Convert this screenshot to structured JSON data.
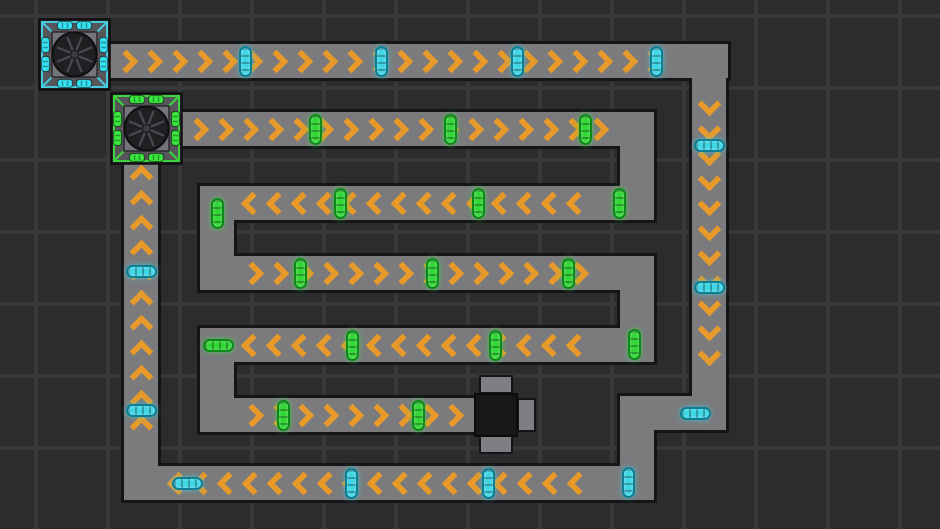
{
  "scene": {
    "width": 940,
    "height": 529,
    "description": "top-down conveyor-belt factory puzzle"
  },
  "palette": {
    "background": "#2c2c2e",
    "grid_line": "#38383a",
    "belt_fill": "#7b7b7d",
    "belt_border": "#151517",
    "chevron_orange": "#e79929",
    "cyan_item_fill": "#3fd6e6",
    "cyan_item_border": "#0d7f95",
    "green_item_fill": "#32d636",
    "green_item_border": "#0c8a18",
    "machine_body": "#55555a",
    "machine_face": "#74747a",
    "machine_circle": "#202023",
    "machine_spoke": "#494950",
    "cyan_accent": "#45cadc",
    "cyan_port": "#35e2f2",
    "green_accent": "#3bd43f",
    "green_port": "#3ae83e",
    "consumer_tab": "#7e7e82",
    "consumer_core": "#18181a"
  },
  "grid": {
    "spacing": 72,
    "line_width": 4
  },
  "chevron": {
    "spacing": 25,
    "arm": 17,
    "thickness": 6
  },
  "belts": [
    {
      "name": "top-run",
      "x": 108,
      "y": 44,
      "w": 620,
      "h": 34,
      "dir": "right",
      "chev": true,
      "m1": 10,
      "m2": 44
    },
    {
      "name": "right-run",
      "x": 692,
      "y": 44,
      "w": 34,
      "h": 386,
      "dir": "down",
      "chev": true,
      "m1": 52,
      "m2": 46
    },
    {
      "name": "jog-horizontal",
      "x": 620,
      "y": 396,
      "w": 106,
      "h": 34,
      "dir": "left",
      "chev": false,
      "m1": 0,
      "m2": 0
    },
    {
      "name": "jog-vertical",
      "x": 620,
      "y": 396,
      "w": 34,
      "h": 104,
      "dir": "down",
      "chev": false,
      "m1": 0,
      "m2": 0
    },
    {
      "name": "bottom-run",
      "x": 124,
      "y": 466,
      "w": 530,
      "h": 34,
      "dir": "left",
      "chev": true,
      "m1": 46,
      "m2": 44
    },
    {
      "name": "left-run",
      "x": 124,
      "y": 160,
      "w": 34,
      "h": 340,
      "dir": "up",
      "chev": true,
      "m1": 8,
      "m2": 44
    },
    {
      "name": "row-a",
      "x": 181,
      "y": 112,
      "w": 473,
      "h": 34,
      "dir": "right",
      "chev": true,
      "m1": 8,
      "m2": 44
    },
    {
      "name": "turn-a-b",
      "x": 620,
      "y": 112,
      "w": 34,
      "h": 108,
      "dir": "down",
      "chev": false,
      "m1": 0,
      "m2": 0
    },
    {
      "name": "row-b",
      "x": 200,
      "y": 186,
      "w": 454,
      "h": 34,
      "dir": "left",
      "chev": true,
      "m1": 44,
      "m2": 44
    },
    {
      "name": "turn-b-c",
      "x": 200,
      "y": 186,
      "w": 34,
      "h": 104,
      "dir": "down",
      "chev": false,
      "m1": 0,
      "m2": 0
    },
    {
      "name": "row-c",
      "x": 200,
      "y": 256,
      "w": 454,
      "h": 34,
      "dir": "right",
      "chev": true,
      "m1": 44,
      "m2": 44
    },
    {
      "name": "turn-c-d",
      "x": 620,
      "y": 256,
      "w": 34,
      "h": 106,
      "dir": "down",
      "chev": false,
      "m1": 0,
      "m2": 0
    },
    {
      "name": "row-d",
      "x": 200,
      "y": 328,
      "w": 454,
      "h": 34,
      "dir": "left",
      "chev": true,
      "m1": 44,
      "m2": 44
    },
    {
      "name": "turn-d-e",
      "x": 200,
      "y": 328,
      "w": 34,
      "h": 104,
      "dir": "down",
      "chev": false,
      "m1": 0,
      "m2": 0
    },
    {
      "name": "row-e",
      "x": 200,
      "y": 398,
      "w": 276,
      "h": 34,
      "dir": "right",
      "chev": true,
      "m1": 44,
      "m2": 10
    }
  ],
  "items": [
    {
      "x": 245,
      "y": 61,
      "o": "v",
      "c": "cyan"
    },
    {
      "x": 381,
      "y": 61,
      "o": "v",
      "c": "cyan"
    },
    {
      "x": 517,
      "y": 61,
      "o": "v",
      "c": "cyan"
    },
    {
      "x": 656,
      "y": 61,
      "o": "v",
      "c": "cyan"
    },
    {
      "x": 709,
      "y": 145,
      "o": "h",
      "c": "cyan"
    },
    {
      "x": 709,
      "y": 287,
      "o": "h",
      "c": "cyan"
    },
    {
      "x": 695,
      "y": 413,
      "o": "h",
      "c": "cyan"
    },
    {
      "x": 628,
      "y": 482,
      "o": "v",
      "c": "cyan"
    },
    {
      "x": 488,
      "y": 483,
      "o": "v",
      "c": "cyan"
    },
    {
      "x": 351,
      "y": 483,
      "o": "v",
      "c": "cyan"
    },
    {
      "x": 187,
      "y": 483,
      "o": "h",
      "c": "cyan"
    },
    {
      "x": 141,
      "y": 410,
      "o": "h",
      "c": "cyan"
    },
    {
      "x": 141,
      "y": 271,
      "o": "h",
      "c": "cyan"
    },
    {
      "x": 315,
      "y": 129,
      "o": "v",
      "c": "green"
    },
    {
      "x": 450,
      "y": 129,
      "o": "v",
      "c": "green"
    },
    {
      "x": 585,
      "y": 129,
      "o": "v",
      "c": "green"
    },
    {
      "x": 619,
      "y": 203,
      "o": "v",
      "c": "green"
    },
    {
      "x": 478,
      "y": 203,
      "o": "v",
      "c": "green"
    },
    {
      "x": 340,
      "y": 203,
      "o": "v",
      "c": "green"
    },
    {
      "x": 217,
      "y": 213,
      "o": "v",
      "c": "green"
    },
    {
      "x": 300,
      "y": 273,
      "o": "v",
      "c": "green"
    },
    {
      "x": 432,
      "y": 273,
      "o": "v",
      "c": "green"
    },
    {
      "x": 568,
      "y": 273,
      "o": "v",
      "c": "green"
    },
    {
      "x": 634,
      "y": 344,
      "o": "v",
      "c": "green"
    },
    {
      "x": 495,
      "y": 345,
      "o": "v",
      "c": "green"
    },
    {
      "x": 352,
      "y": 345,
      "o": "v",
      "c": "green"
    },
    {
      "x": 218,
      "y": 345,
      "o": "h",
      "c": "green"
    },
    {
      "x": 283,
      "y": 415,
      "o": "v",
      "c": "green"
    },
    {
      "x": 418,
      "y": 415,
      "o": "v",
      "c": "green"
    },
    {
      "x": 496,
      "y": 414,
      "o": "v",
      "c": "green"
    }
  ],
  "machines": [
    {
      "name": "machine-cyan",
      "x": 38,
      "y": 18,
      "size": 73,
      "color": "cyan"
    },
    {
      "name": "machine-green",
      "x": 110,
      "y": 92,
      "size": 73,
      "color": "green"
    }
  ],
  "consumer": {
    "core": {
      "x": 474,
      "y": 393,
      "w": 44,
      "h": 44
    },
    "tabs": [
      {
        "x": 479,
        "y": 375,
        "w": 34,
        "h": 19
      },
      {
        "x": 479,
        "y": 435,
        "w": 34,
        "h": 19
      },
      {
        "x": 517,
        "y": 398,
        "w": 19,
        "h": 34
      }
    ]
  }
}
